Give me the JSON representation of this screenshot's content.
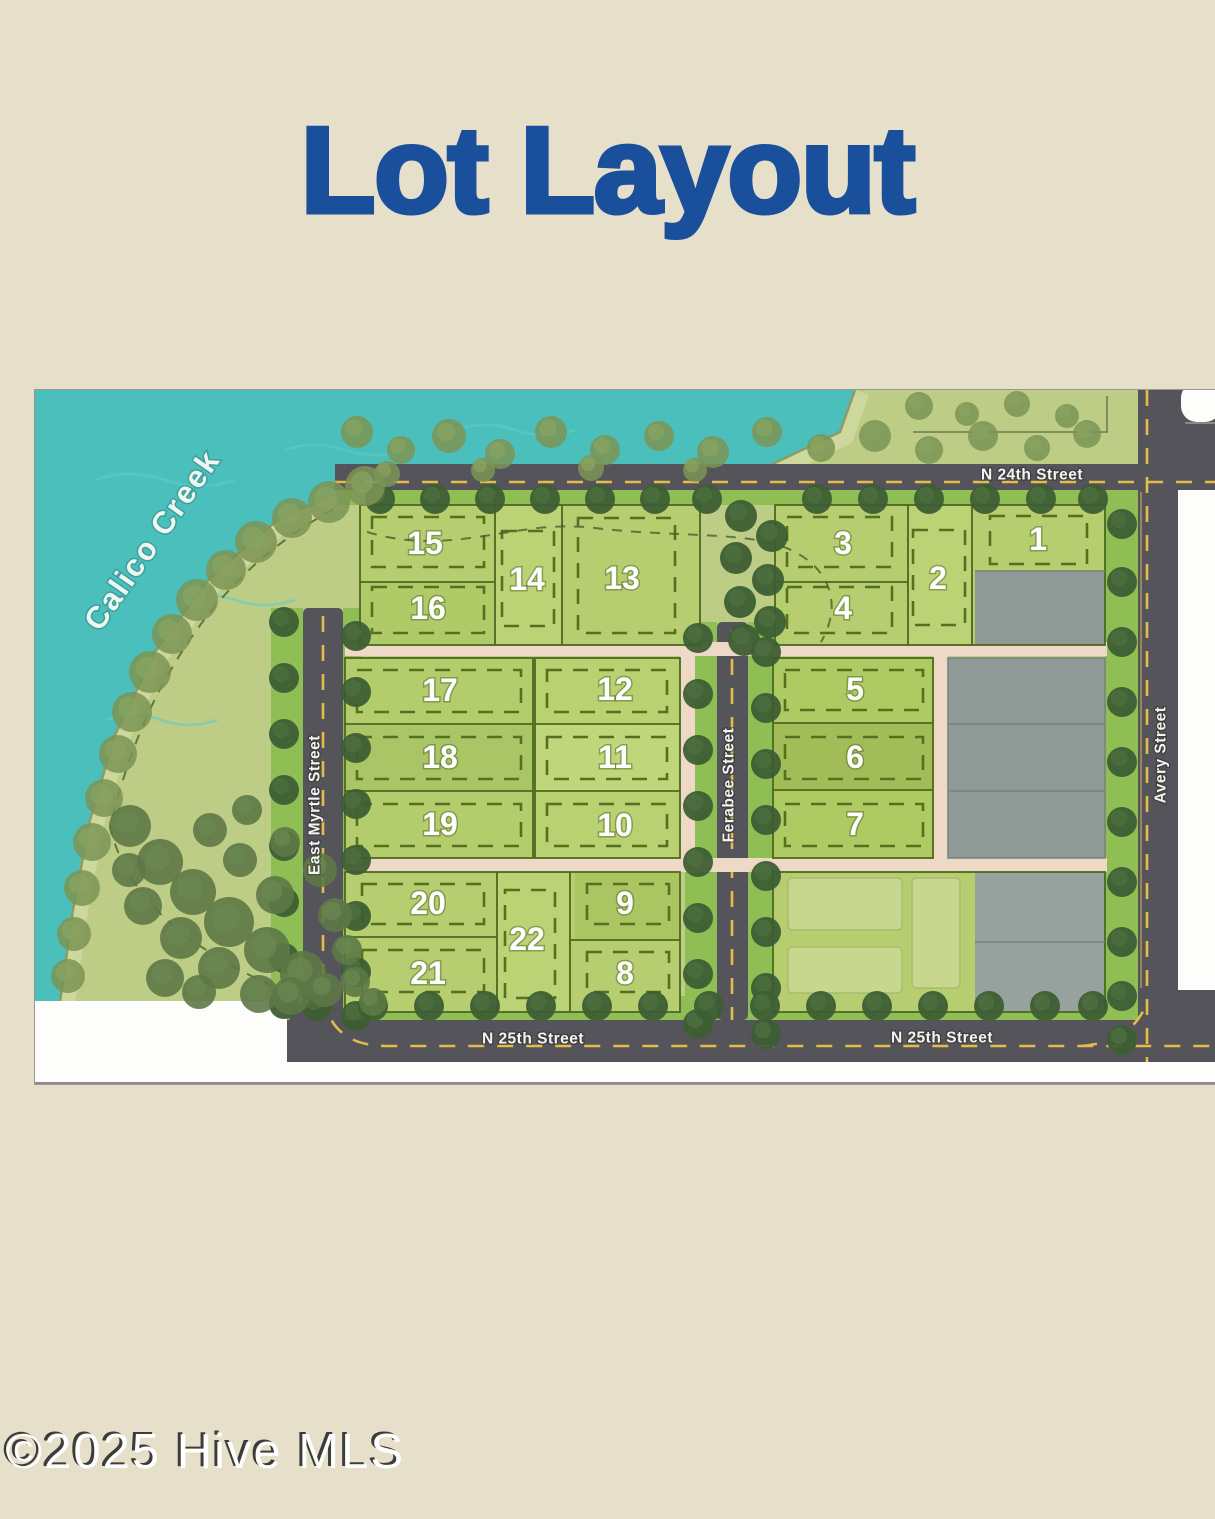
{
  "page": {
    "title": "Lot Layout",
    "watermark": "©2025 Hive MLS"
  },
  "map": {
    "creek_label": "Calico Creek",
    "streets": {
      "n24th": "N 24th Street",
      "n25th": "N 25th Street",
      "avery": "Avery Street",
      "ferabee": "Ferabee Street",
      "east_myrtle": "East Myrtle Street"
    },
    "lots": {
      "1": "1",
      "2": "2",
      "3": "3",
      "4": "4",
      "5": "5",
      "6": "6",
      "7": "7",
      "8": "8",
      "9": "9",
      "10": "10",
      "11": "11",
      "12": "12",
      "13": "13",
      "14": "14",
      "15": "15",
      "16": "16",
      "17": "17",
      "18": "18",
      "19": "19",
      "20": "20",
      "21": "21",
      "22": "22"
    }
  },
  "colors": {
    "title_blue": "#1a4f9b",
    "page_beige": "#e6dfca",
    "water_teal": "#4abfbc",
    "land_green": "#bdcd85",
    "lot_green": "#b6ce6f",
    "buffer_green": "#8fbe55",
    "road_gray": "#54545a",
    "sidewalk_tan": "#eed9c7",
    "gray_lot": "#8f9a97",
    "line_yellow": "#e3bc4a"
  }
}
